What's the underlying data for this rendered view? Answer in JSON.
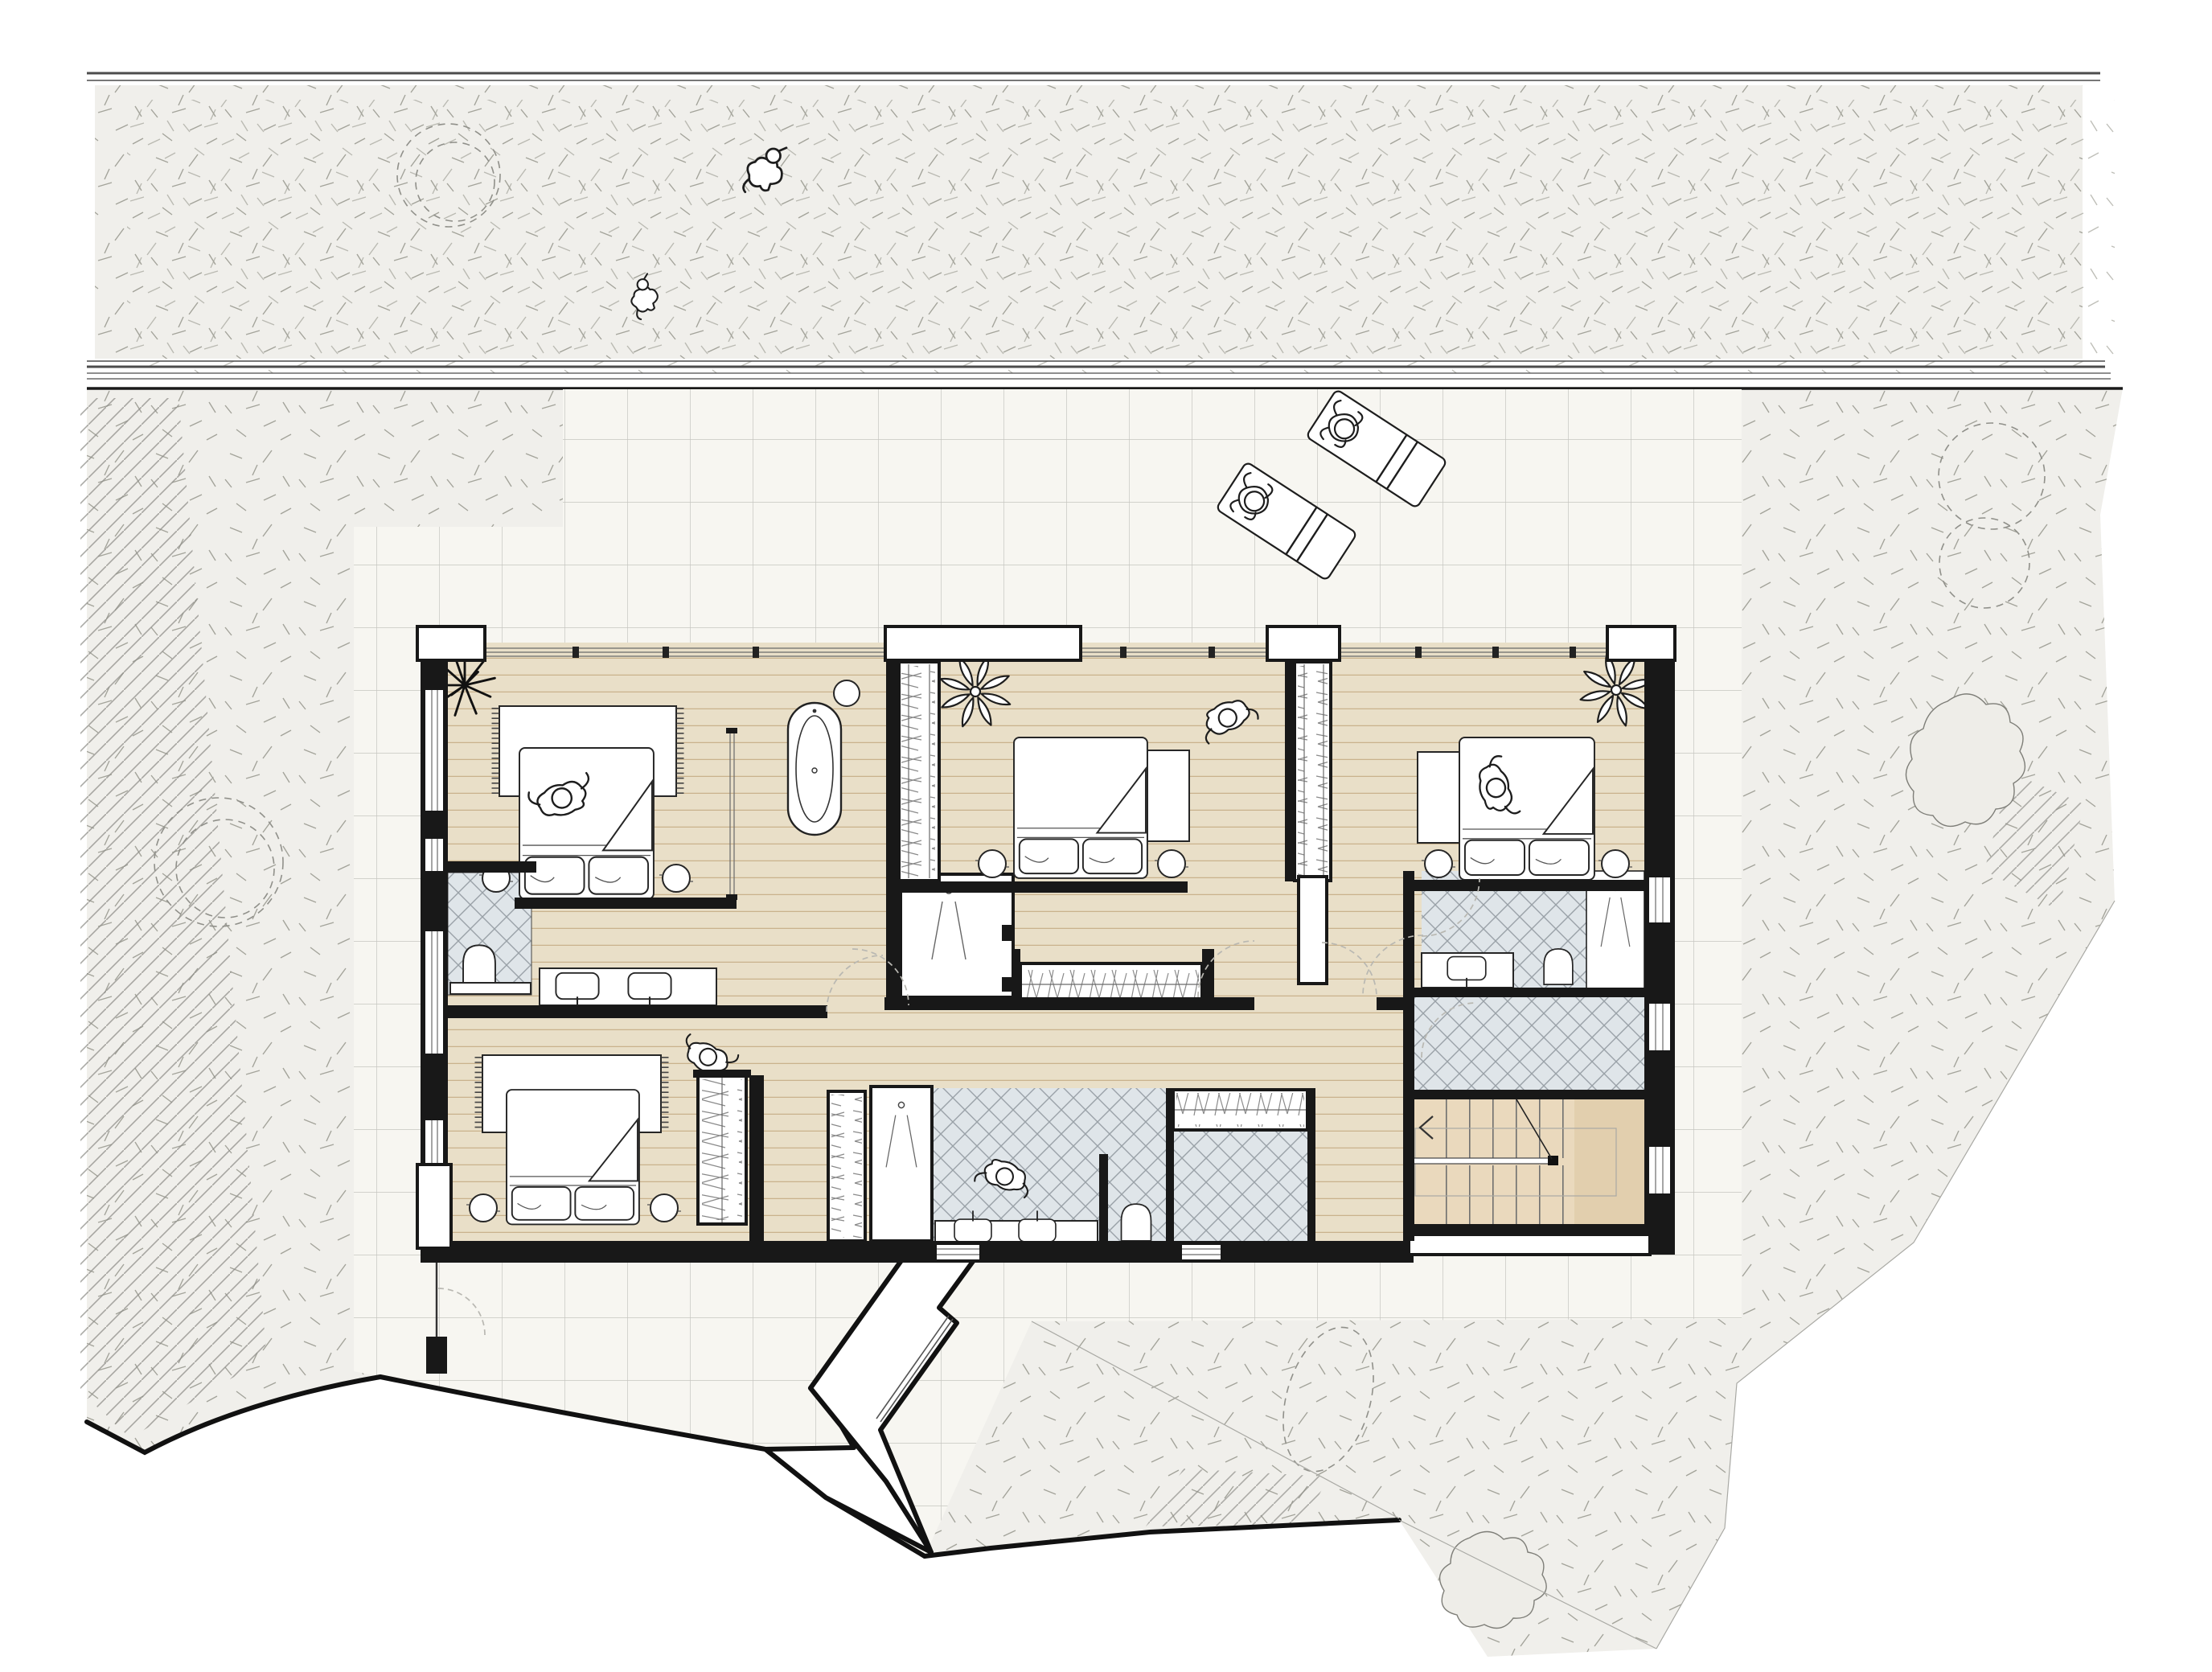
{
  "document": {
    "kind": "architectural floor plan",
    "storey": "bedroom level with site context",
    "visible_text": []
  },
  "palette": {
    "background": "#ffffff",
    "wall": "#181818",
    "wood_floor": "#e9dfc8",
    "plank_line": "#c9b28c",
    "bathroom_tile": "#dfe5e9",
    "tile_line": "#99a1a7",
    "stair_floor": "#ead9bd",
    "stair_landing": "#e2cfae",
    "patio": "#f7f6f1",
    "patio_grid": "#c6c5c0",
    "grass": "#f0efeb",
    "grass_stipple": "#a3a39a",
    "road_line": "#4c4c4c",
    "door_swing": "#b9b8b2"
  },
  "inventory": {
    "bedrooms": 4,
    "beds": 4,
    "bathrooms": 4,
    "showers": 3,
    "toilets": 3,
    "sinks": 5,
    "bathtubs": 1,
    "wardrobe_runs": 6,
    "staircases": 1,
    "sun_loungers": 2,
    "people_figures": 7,
    "animal_figures": 2,
    "potted_plants": 3,
    "rugs": 2,
    "side_tables": 8,
    "dashed_trees": 5,
    "bushes": 2
  }
}
